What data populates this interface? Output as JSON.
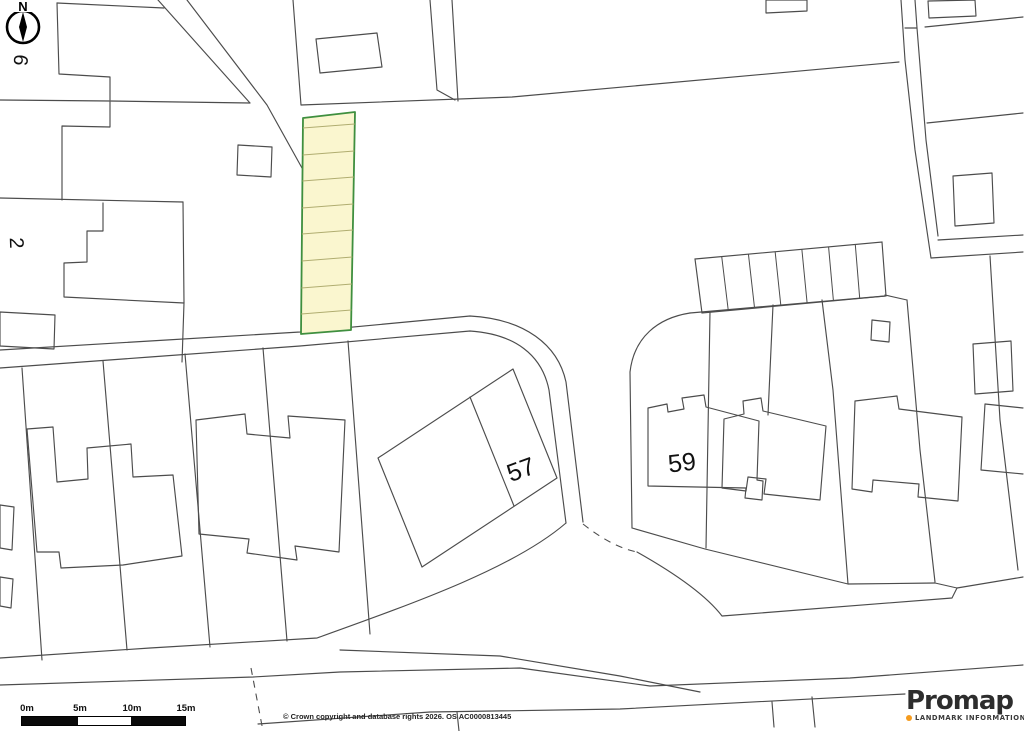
{
  "canvas": {
    "width": 1024,
    "height": 731,
    "background": "#ffffff"
  },
  "colors": {
    "boundary_line": "#4c4c4c",
    "building_line": "#4c4c4c",
    "highlight_fill": "#faf6cf",
    "highlight_stroke": "#3f8f3f",
    "highlight_divider": "#b0ad70",
    "label_text": "#111111",
    "scalebar_black": "#0a0a0a",
    "scalebar_white": "#ffffff"
  },
  "compass": {
    "north_label": "N"
  },
  "plot_labels": [
    {
      "text": "6",
      "x": 20,
      "y": 60,
      "rotation": 97,
      "size": 20
    },
    {
      "text": "2",
      "x": 16,
      "y": 243,
      "rotation": 88,
      "size": 20
    },
    {
      "text": "57",
      "x": 521,
      "y": 470,
      "rotation": -20,
      "size": 25
    },
    {
      "text": "59",
      "x": 682,
      "y": 463,
      "rotation": -7,
      "size": 25
    }
  ],
  "highlight_plot": {
    "outline": [
      [
        303,
        118
      ],
      [
        355,
        112
      ],
      [
        351,
        330
      ],
      [
        301,
        334
      ]
    ],
    "divider_ys": [
      128,
      155,
      181,
      208,
      234,
      261,
      288,
      314
    ],
    "divider_tilt": -4
  },
  "garage_row": {
    "outline": [
      [
        695,
        259
      ],
      [
        882,
        242
      ],
      [
        886,
        296
      ],
      [
        702,
        313
      ]
    ],
    "cells": 7
  },
  "map_lines": [
    "M57,3 L59,74 L110,77 L110,100",
    "M0,100 L110,101 L250,103",
    "M57,3 L164,8",
    "M158,0 L250,103",
    "M187,0 L267,105 L302,168",
    "M62,200 L62,126 L110,127 L110,102",
    "M0,198 L183,202",
    "M183,202 L184,303",
    "M103,203 L103,231 L87,231 L87,262 L64,263 L64,297 L184,303",
    "M184,303 L182,362",
    "M293,0 L301,105",
    "M301,105 L512,97 L899,62",
    "M430,0 L437,90 L455,100",
    "M452,0 L458,101",
    "M901,0 L905,60 L915,150 L931,258",
    "M915,0 L917,28 L926,140 L938,236",
    "M905,28 L917,28",
    "M925,27 L1023,17",
    "M927,123 L1023,113",
    "M931,258 L1023,252",
    "M938,240 L1023,235",
    "M990,256 L1000,420 L1018,570",
    "M907,300 L920,450 L935,582",
    "M885,295 L907,300",
    "M0,350 L150,341 L300,332 L470,316 C525,319 558,345 566,382 L583,522",
    "M0,368 L150,357 L300,346 L470,331 C515,334 542,355 549,390 L566,523",
    "M690,313 C658,318 634,337 630,372 L632,528",
    "M690,313 L885,296",
    "M632,528 L705,549 L848,584 L935,583 L957,588 L1023,577",
    "M637,552 C685,579 709,599 722,616 L952,598 L957,588",
    "M0,658 L150,648 L317,638 C420,601 515,567 566,523",
    "M0,685 L253,677 L340,672 L520,668 L650,686 L850,678 L1023,665",
    "M340,650 L500,656 L620,676 L700,692",
    "M258,724 L430,712 L620,709 L905,694",
    "M457,712 L459,731",
    "M772,702 L774,727",
    "M812,697 L815,727",
    "M22,368 L42,660",
    "M103,361 L127,650",
    "M185,354 L210,647",
    "M263,348 L287,641",
    "M348,341 L370,634",
    "M710,312 L706,548",
    "M822,300 L833,390 L848,584",
    "M470,397 L514,506",
    "M773,305 L768,415",
    "M1023,408 L985,404 L981,470 L1023,474"
  ],
  "dashed_lines": [
    "M251,668 L263,731",
    "M583,524 Q612,547 637,552"
  ],
  "buildings": [
    "M0,312 L55,315 L54,349 L0,346 Z",
    "M238,145 L272,147 L271,177 L237,175 Z",
    "M316,39 L377,33 L382,67 L320,73 Z",
    "M766,0 L807,0 L807,11 L766,13 Z",
    "M928,1 L975,0 L976,16 L929,18 Z",
    "M953,176 L992,173 L994,223 L955,226 Z",
    "M973,344 L1011,341 L1013,391 L975,394 Z",
    "M378,458 L513,369 L557,478 L422,567 Z",
    "M648,408 L667,404 L668,412 L684,409 L682,398 L704,395 L706,407 L759,421 L757,480 L763,481 L762,500 L745,498 L746,488 L648,486 Z",
    "M724,419 L744,414 L743,401 L761,398 L763,411 L826,426 L820,500 L764,494 L766,479 L748,477 L746,491 L722,488 Z",
    "M855,401 L897,396 L899,409 L962,417 L958,501 L918,497 L919,484 L873,480 L872,492 L852,489 Z",
    "M27,429 L53,427 L57,482 L88,479 L87,448 L131,444 L133,477 L173,475 L182,556 L123,565 L61,568 L59,552 L37,552 Z",
    "M196,420 L245,414 L247,434 L290,438 L288,416 L345,420 L339,552 L295,546 L297,560 L247,553 L249,539 L199,534 Z",
    "M0,505 L14,507 L12,550 L0,548 Z",
    "M0,577 L13,579 L11,608 L0,606 Z",
    "M872,320 L890,322 L889,342 L871,340 Z"
  ],
  "scale_bar": {
    "labels": [
      "0m",
      "5m",
      "10m",
      "15m"
    ],
    "label_centers_x": [
      27,
      80,
      132,
      186
    ],
    "bar": {
      "x": 21,
      "y": 716,
      "width": 163,
      "height": 8
    },
    "segment_widths": [
      56,
      53,
      54
    ],
    "segment_colors": [
      "black",
      "white",
      "black"
    ]
  },
  "copyright": "© Crown copyright and database rights 2026. OS AC0000813445",
  "branding": {
    "name": "Promap",
    "tagline": "LANDMARK INFORMATION",
    "dot_color": "#f59b1e"
  }
}
